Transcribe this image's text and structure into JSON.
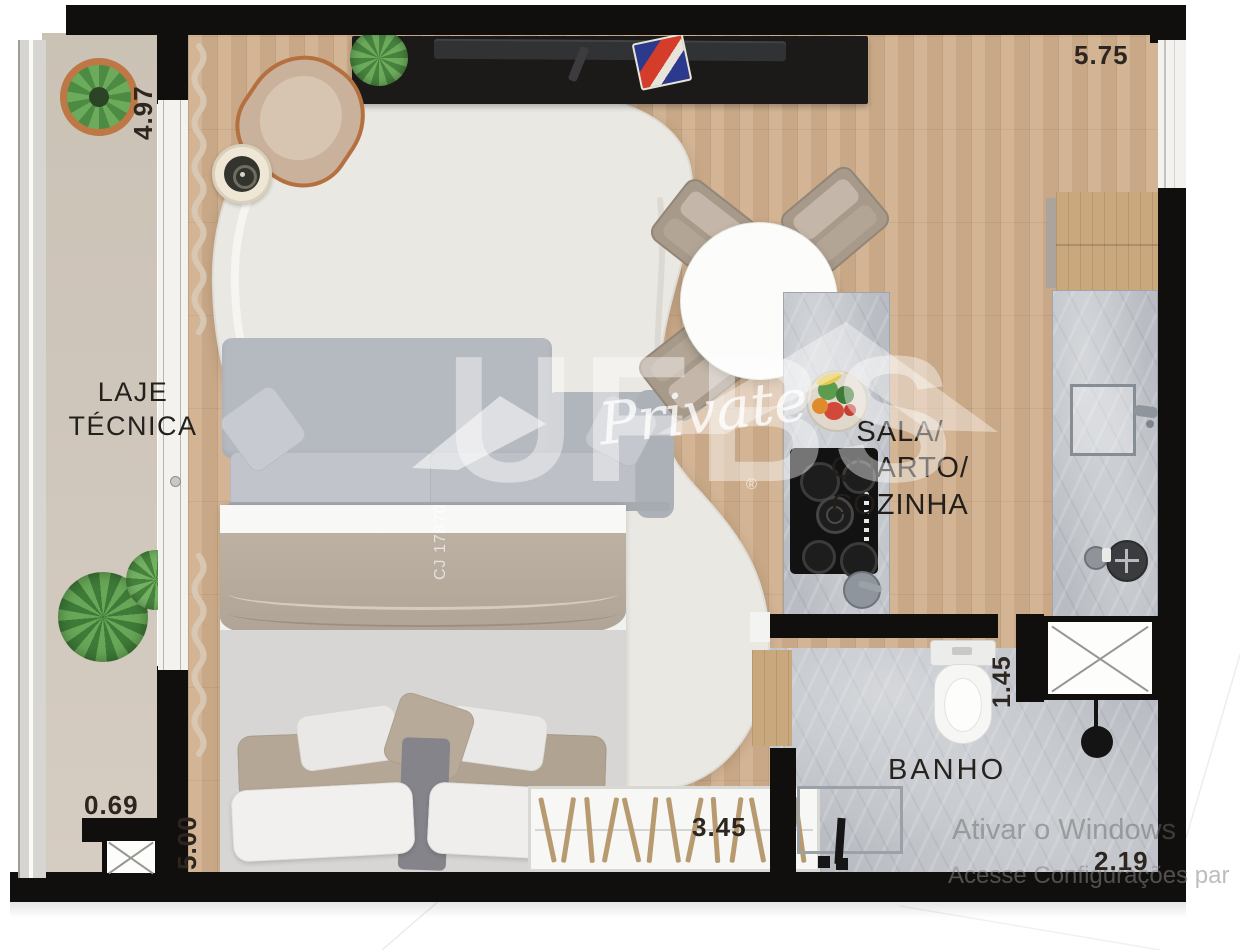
{
  "plan": {
    "rooms": {
      "laje_tecnica": {
        "line1": "LAJE",
        "line2": "TÉCNICA"
      },
      "sala_quarto_cozinha": {
        "line1": "SALA/",
        "line2": "QUARTO/",
        "line3": "COZINHA"
      },
      "banho": {
        "label": "BANHO"
      }
    },
    "dimensions": {
      "balcony_length": "4.97",
      "top_width": "5.75",
      "balcony_door_width": "0.69",
      "bedroom_length": "5.00",
      "bottom_width": "3.45",
      "bathroom_length": "1.45",
      "bathroom_width": "2.19"
    }
  },
  "watermarks": {
    "brand": "UFBS",
    "registered_mark": "®",
    "script_text": "Private",
    "license_code": "CJ 17870"
  },
  "system_overlay": {
    "line1": "Ativar o Windows",
    "line2": "Acesse Configurações par"
  },
  "colors": {
    "wall": "#100f0d",
    "wood_floor": "#cfae8b",
    "balcony_floor": "#cdc4b9",
    "marble": "#b9bdc3",
    "rug": "#eae8e3",
    "sofa_gray": "#b8bcc3",
    "copper_accent": "#b4713f",
    "plant_green": "#5d9b4e"
  }
}
